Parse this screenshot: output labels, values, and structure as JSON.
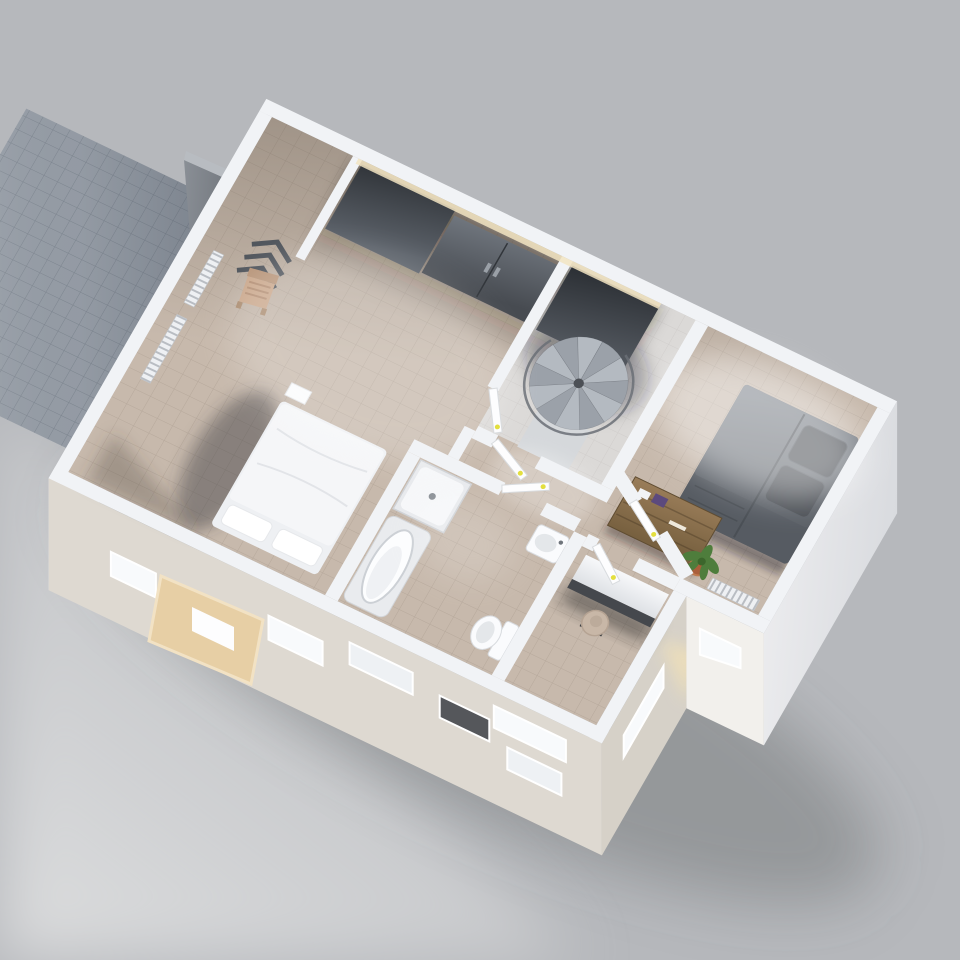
{
  "scene": {
    "kind": "3d-floorplan-render",
    "view": "axonometric-top-down",
    "floor": "upper-floor cutaway model on gray studio background"
  },
  "colors": {
    "background": "#b6b8bc",
    "background_deep": "#acafb4",
    "ground_light": "#d2d3d5",
    "drop_shadow": "#5f6165",
    "terrace": "#99a0a9",
    "terrace_wall": "#787d84",
    "wall": "#f1f3f6",
    "wall_bright": "#fdfdfe",
    "facade_front": "#ded9d1",
    "facade_side": "#d6d1c8",
    "facade_white": "#eef0f2",
    "window_lit": "#f8fafc",
    "window_dark": "#55575b",
    "skylight_frame": "#e7cfa5",
    "carpet": "#c7b9ac",
    "tile_light": "#dbd9d7",
    "wardrobe_dark": "#3a3e43",
    "wardrobe_mid": "#5a5f66",
    "bed_white": "#f5f6f8",
    "bed_dark": "#6d737b",
    "bed_dark_foot": "#565b62",
    "bed_dark_pillow": "#4a4e54",
    "wood": "#8d7251",
    "wood_dark": "#6e583c",
    "stair_metal": "#b4bac1",
    "stair_metal_alt": "#9ba1a9",
    "stair_rail": "#6a6f76",
    "porcelain": "#fafbfd",
    "porcelain_shade": "#e4e7ea",
    "desk_front": "#45484d",
    "chair_seat": "#c8b7a7",
    "plant_green": "#4e7d3c",
    "plant_green_dark": "#3c662c",
    "plant_pot": "#aa5f3b",
    "handle_yellow": "#e3df3f"
  },
  "rooms": [
    {
      "name": "walk-in-closet",
      "furniture": [
        "tall-wardrobe",
        "double-door-cabinet",
        "tall-wardrobe-2"
      ]
    },
    {
      "name": "master-room",
      "furniture": [
        "double-bed-white",
        "wall-radiator-upper",
        "wall-radiator-lower",
        "valet-chair",
        "coat-rack"
      ]
    },
    {
      "name": "stairwell",
      "furniture": [
        "spiral-staircase"
      ]
    },
    {
      "name": "bedroom",
      "furniture": [
        "double-bed-dark",
        "wood-dresser",
        "radiator",
        "potted-plant"
      ]
    },
    {
      "name": "bathroom",
      "furniture": [
        "shower-tray",
        "bathtub",
        "washbasin",
        "toilet",
        "towel-rail"
      ]
    },
    {
      "name": "study",
      "furniture": [
        "long-desk",
        "office-chair"
      ]
    },
    {
      "name": "hallway",
      "furniture": [
        "door-master-room",
        "door-stairwell",
        "door-bathroom",
        "door-study",
        "door-bedroom"
      ]
    }
  ],
  "exterior": {
    "elements": [
      "roof-terrace",
      "terrace-wall-fragment",
      "facade-window-slits",
      "skylight-frame",
      "open-window-dark"
    ]
  }
}
